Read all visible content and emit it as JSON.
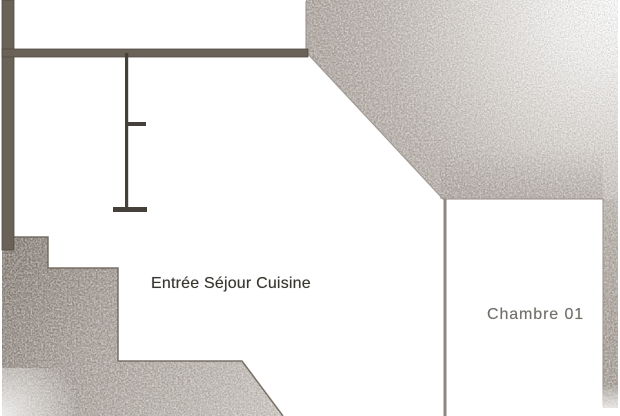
{
  "plan": {
    "rooms": [
      {
        "id": "entree-sejour-cuisine",
        "label": "Entrée Séjour Cuisine"
      },
      {
        "id": "chambre-01",
        "label": "Chambre 01"
      }
    ]
  },
  "colors": {
    "background": "#ffffff",
    "wall_dark": "#6a6157",
    "partition_line": "#45413a",
    "bedroom_wall_line": "#8d8781",
    "shading_gray": "#a49b93",
    "shading_gray_light": "#cdc7c0",
    "label_dark": "#38352f",
    "label_light": "#716d68"
  }
}
